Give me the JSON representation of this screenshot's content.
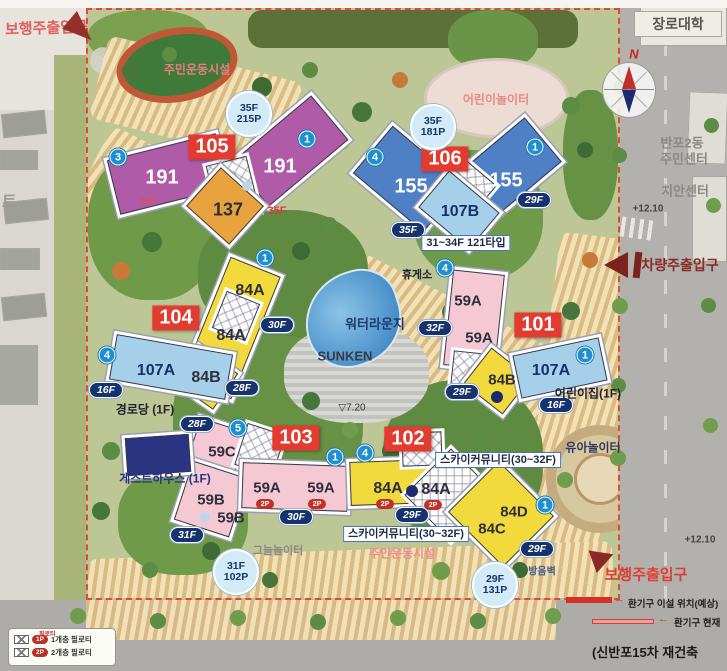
{
  "title": "(신반포15차 재건축",
  "colors": {
    "building_label_bg": "#e23b30",
    "type_191_purple": "#b05ba8",
    "type_155_blue": "#4f7fc5",
    "type_84_yellow": "#f2d93c",
    "type_59_pink": "#f4c9d4",
    "type_107_lightblue": "#a6d0ea",
    "type_137_orange": "#e8a23e",
    "floor_oval_bg": "#16336e",
    "circled_num_bg": "#1e90d0",
    "parking_badge_bg": "#d2ebf6",
    "entrance_arrow": "#8a2a28",
    "entrance_text": "#e03c34"
  },
  "buildings": {
    "b105": {
      "label": "105",
      "u1": "191",
      "u2": "191",
      "u3": "137",
      "badge_l1": "35F",
      "badge_l2": "215P",
      "num_left": "3",
      "num_right": "1",
      "mark_left": "26F",
      "mark_right": "35F"
    },
    "b106": {
      "label": "106",
      "u1": "155",
      "u2": "155",
      "u3": "107B",
      "badge_l1": "35F",
      "badge_l2": "181P",
      "num_left": "4",
      "num_right": "1",
      "floor_left": "35F",
      "floor_right": "29F",
      "type_note": "31~34F 121타입"
    },
    "b104": {
      "label": "104",
      "u1": "84A",
      "u2": "84A",
      "u3": "84B",
      "u4": "107A",
      "num_top": "1",
      "num_left": "4",
      "floor_right": "30F",
      "floor_left": "16F",
      "floor_bottom": "28F"
    },
    "b101": {
      "label": "101",
      "u1": "59A",
      "u2": "59A",
      "u3": "84B",
      "u4": "107A",
      "num_top": "4",
      "num_right": "1",
      "floor_left": "32F",
      "floor_bottom": "29F",
      "floor_107a": "16F"
    },
    "b103": {
      "label": "103",
      "u1": "59C",
      "u2": "59B",
      "u3": "59B",
      "u4": "59A",
      "u5": "59A",
      "num_top": "5",
      "num_right": "1",
      "floor_top": "28F",
      "floor_left": "31F",
      "floor_bottom": "30F",
      "badge_l1": "31F",
      "badge_l2": "102P",
      "p1": "2P",
      "p2": "2P"
    },
    "b102": {
      "label": "102",
      "u1": "84A",
      "u2": "84A",
      "u3": "84D",
      "u4": "84C",
      "num_left": "4",
      "num_right": "1",
      "floor_bar": "29F",
      "floor_tower": "29F",
      "badge_l1": "29F",
      "badge_l2": "131P",
      "p1": "2P",
      "p2": "2P",
      "sky1": "스카이커뮤니티(30~32F)",
      "sky2": "스카이커뮤니티(30~32F)"
    }
  },
  "facilities": {
    "sports_top": "주민운동시설",
    "sports_bottom": "주민운동시설",
    "kids_playground": "어린이놀이터",
    "toddler_playground": "유아놀이터",
    "shade_playground": "그늘놀이터",
    "water_lounge": "워터라운지",
    "sunken": "SUNKEN",
    "rest_area": "휴게소",
    "senior_center": "경로당 (1F)",
    "daycare": "어린이집(1F)",
    "guesthouse": "게스트하우스 (1F)",
    "soundproof_wall": "방음벽"
  },
  "entrances": {
    "pedestrian_top": "보행주출입구",
    "pedestrian_bottom": "보행주출입구",
    "vehicle": "차량주출입구"
  },
  "surroundings": {
    "university": "장로대학",
    "community_center_line1": "반포2동",
    "community_center_line2": "주민센터",
    "police_center": "치안센터",
    "adjacent_apartment_partial": "트",
    "compass_north": "N"
  },
  "elevations": {
    "site_center": "▽7.20",
    "road_right": "+12.10",
    "road_bottom": "+12.10"
  },
  "vents": {
    "relocated": "환기구 이설 위치(예상)",
    "current": "환기구 현재",
    "arrow": "←"
  },
  "legend": {
    "header": "필로티",
    "row1_badge": "1P",
    "row1_text": "1개층 필로티",
    "row2_badge": "2P",
    "row2_text": "2개층 필로티"
  }
}
